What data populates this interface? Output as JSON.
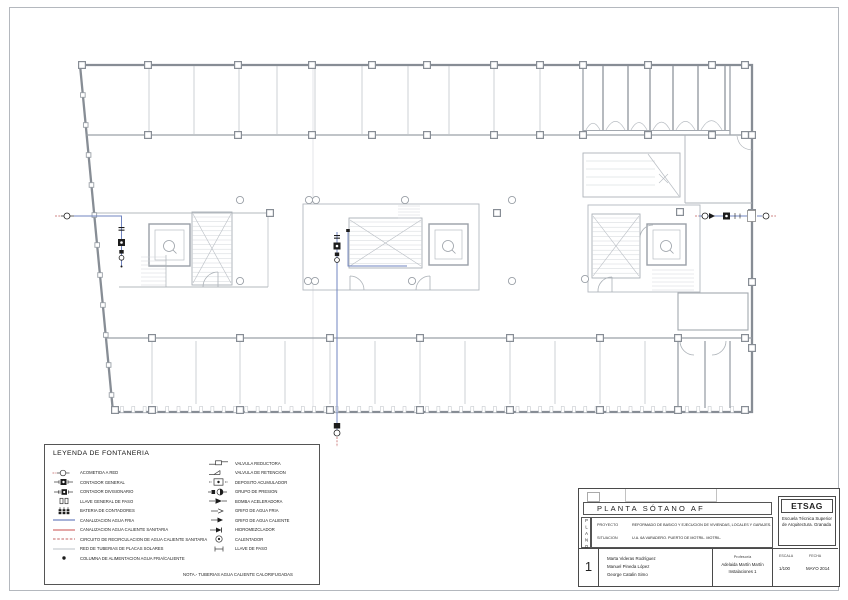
{
  "legend": {
    "title": "LEYENDA DE FONTANERIA",
    "note": "NOTA.-   TUBERIAS AGUA CALIENTE CALORIFUGADAS",
    "left_items": [
      {
        "icon": "acometida",
        "label": "ACOMETIDA A RED"
      },
      {
        "icon": "contador-general",
        "label": "CONTADOR GENERAL"
      },
      {
        "icon": "contador-divisionario",
        "label": "CONTADOR DIVISIONARIO"
      },
      {
        "icon": "llave-general",
        "label": "LLAVE GENERAL DE PASO"
      },
      {
        "icon": "bateria-contadores",
        "label": "BATERIA DE CONTADORES"
      },
      {
        "icon": "canalizacion-fria",
        "label": "CANALIZACION AGUA FRIA"
      },
      {
        "icon": "canalizacion-acs",
        "label": "CANALIZACION AGUA CALIENTE SANITARIA"
      },
      {
        "icon": "recirculacion-acs",
        "label": "CIRCUITO DE RECIRCULACION DE AGUA CALIENTE SANITARIA"
      },
      {
        "icon": "placas-solares",
        "label": "RED DE TUBERIAS DE PLACAS SOLARES"
      },
      {
        "icon": "columna-alimentacion",
        "label": "COLUMNA DE ALIMENTACION AGUA FRIA/CALIENTE"
      }
    ],
    "right_items": [
      {
        "icon": "valvula-reductora",
        "label": "VALVULA REDUCTORA"
      },
      {
        "icon": "valvula-retencion",
        "label": "VALVULA DE RETENCION"
      },
      {
        "icon": "deposito-acumulador",
        "label": "DEPOSITO ACUMULADOR"
      },
      {
        "icon": "grupo-presion",
        "label": "GRUPO DE PRESION"
      },
      {
        "icon": "bomba-aceleradora",
        "label": "BOMBA ACELERADORA"
      },
      {
        "icon": "grifo-fria",
        "label": "GRIFO DE AGUA FRIA"
      },
      {
        "icon": "grifo-caliente",
        "label": "GRIFO DE AGUA CALIENTE"
      },
      {
        "icon": "hidromezclador",
        "label": "HIDROMEZCLADOR"
      },
      {
        "icon": "calentador",
        "label": "CALENTADOR"
      },
      {
        "icon": "llave-paso",
        "label": "LLAVE DE PASO"
      }
    ]
  },
  "title_block": {
    "plano_vertical": "PLANO",
    "title": "PLANTA SÓTANO AF",
    "proyecto_label": "PROYECTO",
    "proyecto_text": "REFORMADO DE BASICO Y EJECUCION DE VIVIENDAS, LOCALES Y GARAJES.",
    "situacion_label": "SITUACION",
    "situacion_text": "U.A. 6A VARADERO. PUERTO DE MOTRIL. MOTRIL.",
    "sheet_number": "1",
    "authors": [
      "Marta Videras Rodríguez",
      "Manuel Pineda López",
      "George Catalin Simo"
    ],
    "professor_label": "Profesor/a",
    "professor_name": "Adelaida Martín Martín",
    "course": "Instalaciones 1",
    "escala_label": "ESCALA",
    "escala_value": "1/100",
    "fecha_label": "FECHA",
    "fecha_value": "MAYO 2014",
    "logo": "ETSAG",
    "school": "Escuela Técnica Superior de Arquitectura. Granada"
  },
  "colors": {
    "cold_water": "#7084c0",
    "hot_water": "#e09a9a",
    "recirculation": "#cf8484",
    "solar": "#d2d6da",
    "wall": "#878d95",
    "wall_light": "#b9bec4",
    "symbol": "#1c1c1c"
  }
}
